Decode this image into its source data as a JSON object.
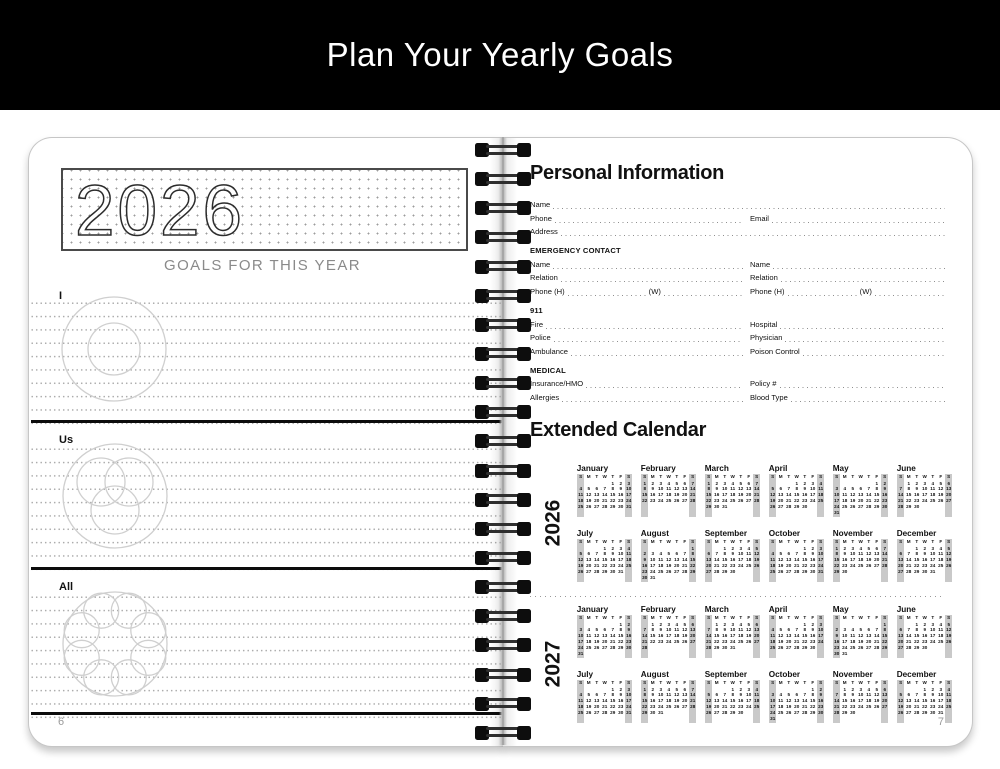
{
  "banner": {
    "title": "Plan Your Yearly Goals",
    "bg_color": "#000000",
    "text_color": "#ffffff"
  },
  "left_page": {
    "year": "2026",
    "caption": "GOALS FOR THIS YEAR",
    "sections": [
      {
        "label": "I"
      },
      {
        "label": "Us"
      },
      {
        "label": "All"
      }
    ],
    "page_number": "6"
  },
  "right_page": {
    "personal_title": "Personal Information",
    "form": {
      "rows": [
        {
          "cells": [
            {
              "parts": [
                "Name"
              ]
            }
          ]
        },
        {
          "cells": [
            {
              "parts": [
                "Phone"
              ]
            },
            {
              "parts": [
                "Email"
              ]
            }
          ]
        },
        {
          "cells": [
            {
              "parts": [
                "Address"
              ]
            }
          ]
        },
        {
          "header": "EMERGENCY CONTACT"
        },
        {
          "cells": [
            {
              "parts": [
                "Name"
              ]
            },
            {
              "parts": [
                "Name"
              ]
            }
          ]
        },
        {
          "cells": [
            {
              "parts": [
                "Relation"
              ]
            },
            {
              "parts": [
                "Relation"
              ]
            }
          ]
        },
        {
          "cells": [
            {
              "parts": [
                "Phone (H)",
                "(W)"
              ]
            },
            {
              "parts": [
                "Phone (H)",
                "(W)"
              ]
            }
          ]
        },
        {
          "header": "911"
        },
        {
          "cells": [
            {
              "parts": [
                "Fire"
              ]
            },
            {
              "parts": [
                "Hospital"
              ]
            }
          ]
        },
        {
          "cells": [
            {
              "parts": [
                "Police"
              ]
            },
            {
              "parts": [
                "Physician"
              ]
            }
          ]
        },
        {
          "cells": [
            {
              "parts": [
                "Ambulance"
              ]
            },
            {
              "parts": [
                "Poison Control"
              ]
            }
          ]
        },
        {
          "header": "MEDICAL"
        },
        {
          "cells": [
            {
              "parts": [
                "Insurance/HMO"
              ]
            },
            {
              "parts": [
                "Policy #"
              ]
            }
          ]
        },
        {
          "cells": [
            {
              "parts": [
                "Allergies"
              ]
            },
            {
              "parts": [
                "Blood Type"
              ]
            }
          ]
        }
      ]
    },
    "calendar_title": "Extended Calendar",
    "weekday_header": [
      "S",
      "M",
      "T",
      "W",
      "T",
      "F",
      "S"
    ],
    "years": [
      {
        "label": "2026",
        "months": [
          {
            "name": "January",
            "start": 4,
            "days": 31
          },
          {
            "name": "February",
            "start": 0,
            "days": 28
          },
          {
            "name": "March",
            "start": 0,
            "days": 31
          },
          {
            "name": "April",
            "start": 3,
            "days": 30
          },
          {
            "name": "May",
            "start": 5,
            "days": 31
          },
          {
            "name": "June",
            "start": 1,
            "days": 30
          },
          {
            "name": "July",
            "start": 3,
            "days": 31
          },
          {
            "name": "August",
            "start": 6,
            "days": 31
          },
          {
            "name": "September",
            "start": 2,
            "days": 30
          },
          {
            "name": "October",
            "start": 4,
            "days": 31
          },
          {
            "name": "November",
            "start": 0,
            "days": 30
          },
          {
            "name": "December",
            "start": 2,
            "days": 31
          }
        ]
      },
      {
        "label": "2027",
        "months": [
          {
            "name": "January",
            "start": 5,
            "days": 31
          },
          {
            "name": "February",
            "start": 1,
            "days": 28
          },
          {
            "name": "March",
            "start": 1,
            "days": 31
          },
          {
            "name": "April",
            "start": 4,
            "days": 30
          },
          {
            "name": "May",
            "start": 6,
            "days": 31
          },
          {
            "name": "June",
            "start": 2,
            "days": 30
          },
          {
            "name": "July",
            "start": 4,
            "days": 31
          },
          {
            "name": "August",
            "start": 0,
            "days": 31
          },
          {
            "name": "September",
            "start": 3,
            "days": 30
          },
          {
            "name": "October",
            "start": 5,
            "days": 31
          },
          {
            "name": "November",
            "start": 1,
            "days": 30
          },
          {
            "name": "December",
            "start": 3,
            "days": 31
          }
        ]
      }
    ],
    "page_number": "7"
  },
  "colors": {
    "page_border": "#c6c6c6",
    "divider_black": "#0c0c0c",
    "dotted_line_gray": "#8f8f8f",
    "circle_stroke_gray": "#cfcfcf",
    "weekend_column_bg": "#c9c9c9",
    "caption_gray": "#8a8a8a",
    "page_number_gray": "#9a9a9a"
  }
}
